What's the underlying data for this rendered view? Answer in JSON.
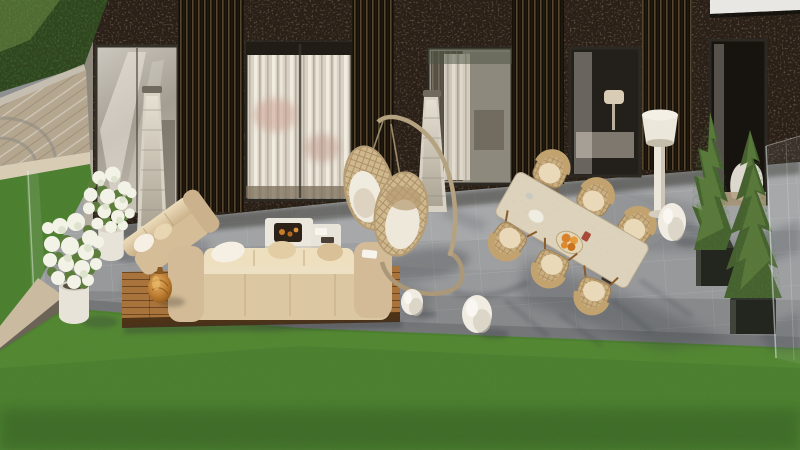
{
  "meta": {
    "scene": "Sunny 3D architectural rendering of a luxury villa terrace",
    "view": "elevated exterior view of patio, lounge furniture and lawn"
  },
  "palette": {
    "facade_stone": "#2a2017",
    "slat": "#15100c",
    "glass": "#b9b4ab",
    "curtain": "#e9e3d6",
    "patio": "#98999b",
    "patio_shadow": "#747678",
    "lawn": "#4d8130",
    "lawn_dark": "#35601f",
    "hedge": "#2f441f",
    "pavers": "#b4a68f",
    "curb": "#d8cdb4",
    "stone_wall": "#c9baa0",
    "deck_wood": "#a9743c",
    "deck_edge": "#4e3317",
    "sofa": "#dcc7a3",
    "sofa_light": "#eee0bf",
    "pillow_white": "#f5f0e3",
    "fire_table": "#ece7dc",
    "fire_bowl": "#2c2218",
    "flame_amber": "#c97c2e",
    "vase_amber": "#b5762c",
    "rattan": "#c9ae80",
    "rattan_dark": "#a8895c",
    "marble_table": "#ddd2bb",
    "wood_leg": "#8a5c2c",
    "lamp_white": "#ece7db",
    "egg_ornament": "#f0ece2",
    "conifer": "#46612f",
    "conifer_light": "#6e8f47",
    "planter_dark": "#23261f",
    "planter_white": "#e8e3d9",
    "flower_white": "#f2f3e6",
    "leaf_green": "#5d7d3c",
    "heater": "#d8d2c5",
    "orange_fruit": "#d9822e"
  },
  "objects": [
    {
      "id": "building-facade",
      "label": "Dark stone villa facade with slatted columns"
    },
    {
      "id": "glass-doors",
      "label": "Floor-to-ceiling glass sliding doors",
      "count": 5
    },
    {
      "id": "patio-heaters",
      "label": "Tower patio heaters",
      "count": 2
    },
    {
      "id": "hydrangea-planters",
      "label": "White planters with white hydrangeas",
      "count": 2
    },
    {
      "id": "lounge-set",
      "label": "Beige outdoor lounge sofas on teak deck platform"
    },
    {
      "id": "fire-pit-table",
      "label": "White fire pit coffee table"
    },
    {
      "id": "decor-vase",
      "label": "Amber glass decor vase"
    },
    {
      "id": "hanging-egg-chairs",
      "label": "Double hanging rattan egg chair on curved stand"
    },
    {
      "id": "dining-set",
      "label": "Travertine dining table with six rattan chairs"
    },
    {
      "id": "fruit-bowl",
      "label": "Bowl with oranges"
    },
    {
      "id": "floor-lamp",
      "label": "White outdoor floor lamp"
    },
    {
      "id": "egg-ornaments",
      "label": "White egg ornaments on patio",
      "count": 3
    },
    {
      "id": "conifer-trees",
      "label": "Potted conifer trees in dark cube planters",
      "count": 2
    },
    {
      "id": "glass-railing",
      "label": "Frameless glass balustrade"
    },
    {
      "id": "stone-courtyard",
      "label": "Stone paved courtyard"
    },
    {
      "id": "hedge",
      "label": "Clipped green hedge"
    },
    {
      "id": "lawn",
      "label": "Manicured green lawn"
    }
  ]
}
